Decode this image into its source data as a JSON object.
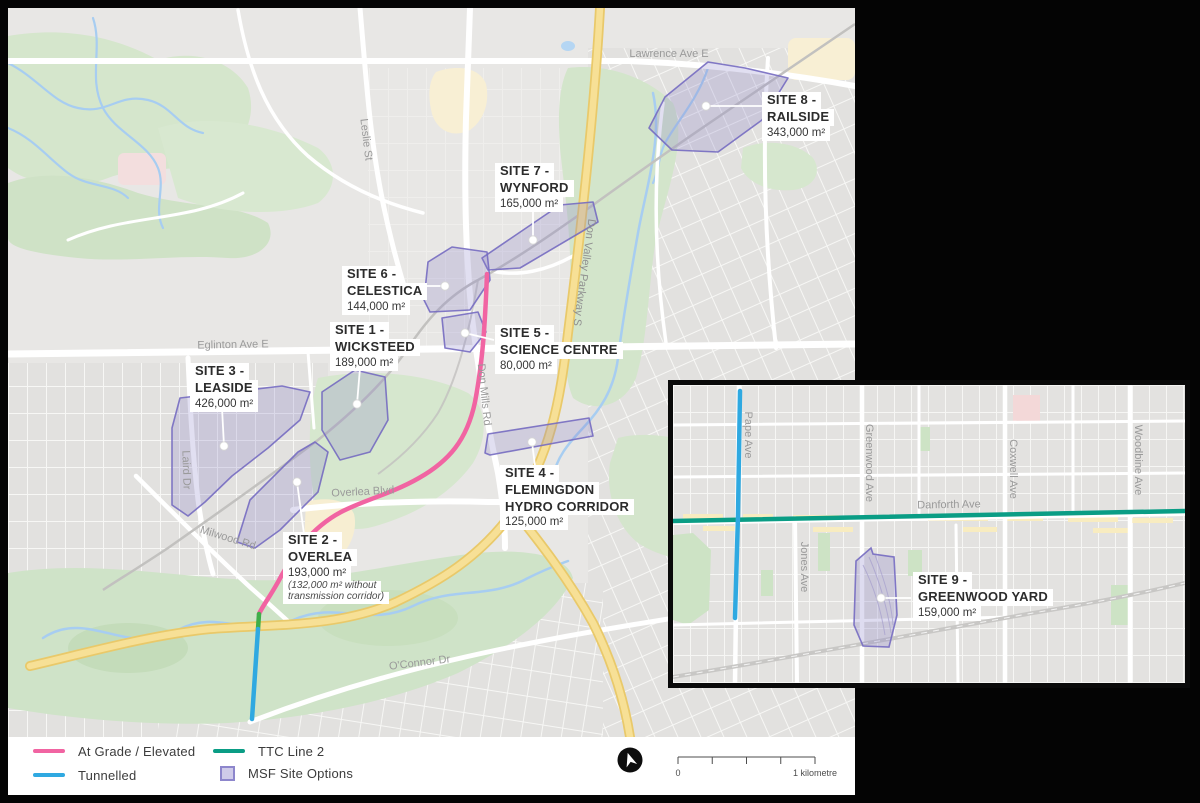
{
  "legend": {
    "at_grade": "At Grade / Elevated",
    "tunnelled": "Tunnelled",
    "ttc_line_2": "TTC Line 2",
    "msf": "MSF Site Options"
  },
  "scalebar": {
    "zero": "0",
    "one": "1 kilometre"
  },
  "sites": {
    "s1": {
      "l1": "SITE 1 -",
      "l2": "WICKSTEED",
      "area": "189,000 m²"
    },
    "s2": {
      "l1": "SITE 2 -",
      "l2": "OVERLEA",
      "area": "193,000 m²",
      "note1": "(132,000 m² without",
      "note2": "transmission corridor)"
    },
    "s3": {
      "l1": "SITE 3 -",
      "l2": "LEASIDE",
      "area": "426,000 m²"
    },
    "s4": {
      "l1": "SITE 4 -",
      "l2": "FLEMINGDON",
      "l3": "HYDRO CORRIDOR",
      "area": "125,000 m²"
    },
    "s5": {
      "l1": "SITE 5 -",
      "l2": "SCIENCE CENTRE",
      "area": "80,000 m²"
    },
    "s6": {
      "l1": "SITE 6 -",
      "l2": "CELESTICA",
      "area": "144,000 m²"
    },
    "s7": {
      "l1": "SITE 7 -",
      "l2": "WYNFORD",
      "area": "165,000 m²"
    },
    "s8": {
      "l1": "SITE 8 -",
      "l2": "RAILSIDE",
      "area": "343,000 m²"
    },
    "s9": {
      "l1": "SITE 9 -",
      "l2": "GREENWOOD YARD",
      "area": "159,000 m²"
    }
  },
  "streets_main": {
    "lawrence": "Lawrence Ave E",
    "leslie": "Leslie St",
    "don_valley": "Don Valley Parkway S",
    "eglinton": "Eglinton Ave E",
    "don_mills": "Don Mills Rd",
    "laird": "Laird Dr",
    "overlea": "Overlea Blvd",
    "millwood": "Milwood Rd",
    "oconnor": "O'Connor Dr"
  },
  "streets_inset": {
    "pape": "Pape Ave",
    "jones": "Jones Ave",
    "greenwood": "Greenwood Ave",
    "coxwell": "Coxwell Ave",
    "woodbine": "Woodbine Ave",
    "danforth": "Danforth Ave"
  },
  "colors": {
    "at_grade_pink": "#f164a2",
    "tunnelled_blue": "#2fa9e1",
    "ttc_green": "#0a9d85",
    "portal_segment_green": "#3fae49",
    "msf_fill": "#cfcbe9",
    "msf_stroke": "#837bc9",
    "highway_yellow": "#f7e096"
  }
}
